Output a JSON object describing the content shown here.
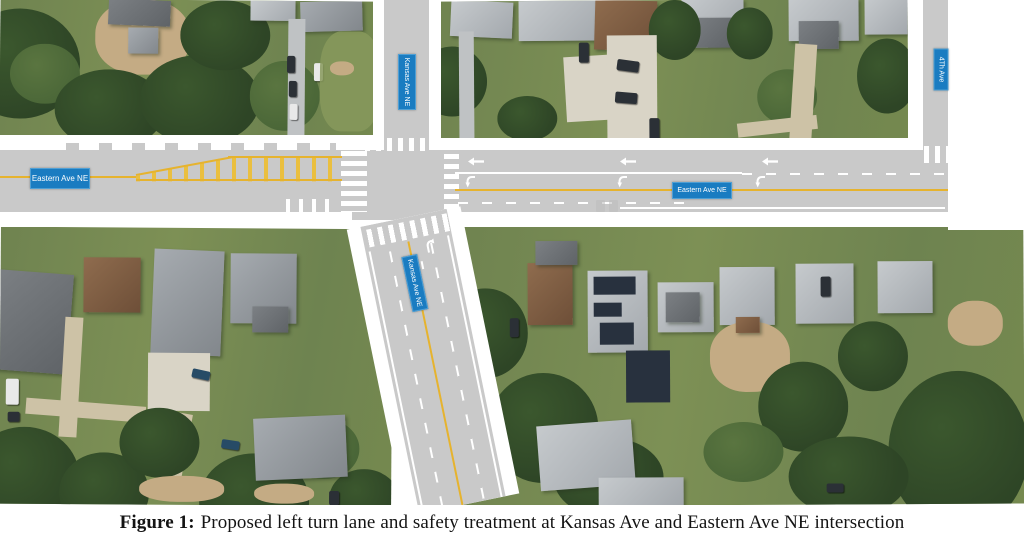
{
  "figure": {
    "label": "Figure 1:",
    "caption": "Proposed left turn lane and safety treatment at Kansas Ave and Eastern Ave NE intersection"
  },
  "map_labels": {
    "eastern_ave_west": "Eastern Ave NE",
    "eastern_ave_east": "Eastern Ave NE",
    "kansas_ave_north": "Kansas Ave NE",
    "kansas_ave_south": "Kansas Ave NE",
    "fourth_ave": "4Th Ave"
  },
  "colors": {
    "road_gray": "#c9c9c9",
    "marking_yellow": "#e6b32e",
    "marking_white": "#ffffff",
    "street_label_blue": "#1a7cc1",
    "street_label_text": "#ffffff"
  }
}
